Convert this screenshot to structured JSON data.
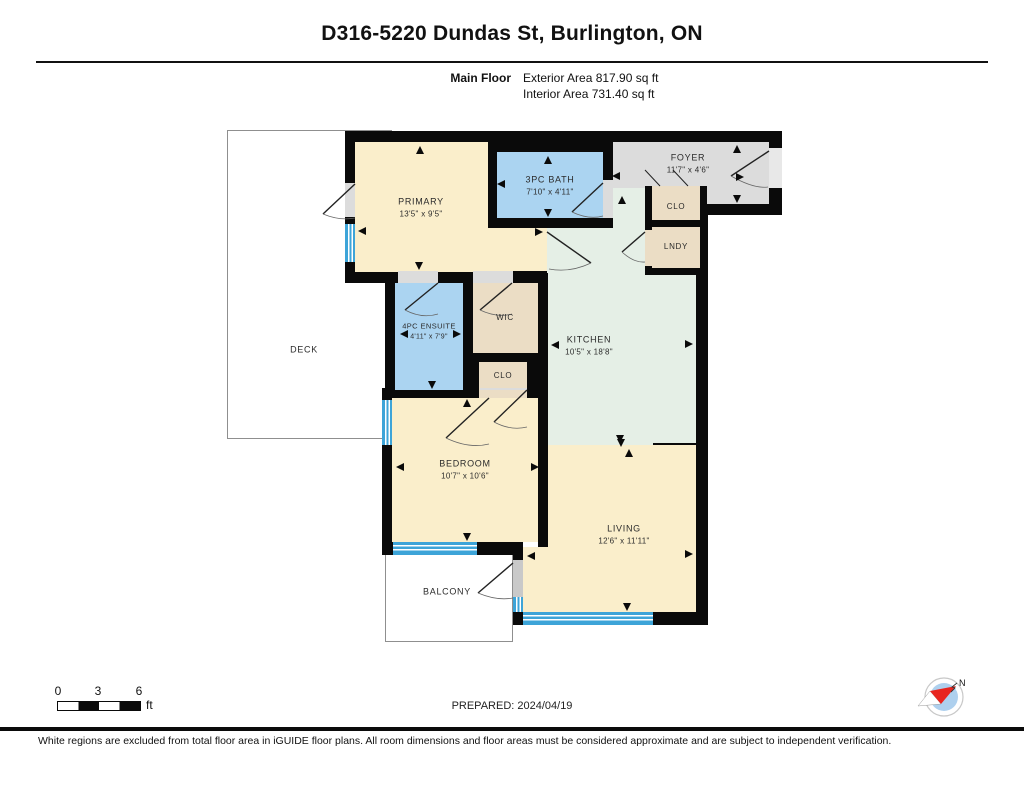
{
  "header": {
    "title": "D316-5220 Dundas St, Burlington, ON",
    "floor_label": "Main Floor",
    "exterior_area": "Exterior Area 817.90 sq ft",
    "interior_area": "Interior Area 731.40 sq ft"
  },
  "rooms": {
    "primary": {
      "name": "PRIMARY",
      "dims": "13'5\" x 9'5\""
    },
    "bath": {
      "name": "3PC BATH",
      "dims": "7'10\" x 4'11\""
    },
    "foyer": {
      "name": "FOYER",
      "dims": "11'7\" x 4'6\""
    },
    "clo_foyer": {
      "name": "CLO"
    },
    "lndy": {
      "name": "LNDY"
    },
    "ensuite": {
      "name": "4PC ENSUITE",
      "dims": "4'11\" x 7'9\""
    },
    "wic": {
      "name": "WIC"
    },
    "clo_hall": {
      "name": "CLO"
    },
    "kitchen": {
      "name": "KITCHEN",
      "dims": "10'5\" x 18'8\""
    },
    "bedroom": {
      "name": "BEDROOM",
      "dims": "10'7\" x 10'6\""
    },
    "living": {
      "name": "LIVING",
      "dims": "12'6\" x 11'11\""
    },
    "deck": {
      "name": "DECK"
    },
    "balcony": {
      "name": "BALCONY"
    }
  },
  "scale_bar": {
    "ticks": [
      "0",
      "3",
      "6"
    ],
    "unit": "ft"
  },
  "prepared_label": "PREPARED: 2024/04/19",
  "compass": {
    "label": "N"
  },
  "footer_note": "White regions are excluded from total floor area in iGUIDE floor plans. All room dimensions and floor areas must be considered approximate and are subject to independent verification.",
  "colors": {
    "wall": "#0a0a0a",
    "room_cream": "#faeecb",
    "room_blue": "#abd4f1",
    "room_green": "#e5efe6",
    "room_gray": "#dcdcdc",
    "room_tan": "#ebddc5",
    "window_blue": "#3da4d8",
    "compass_red": "#e8251f"
  }
}
